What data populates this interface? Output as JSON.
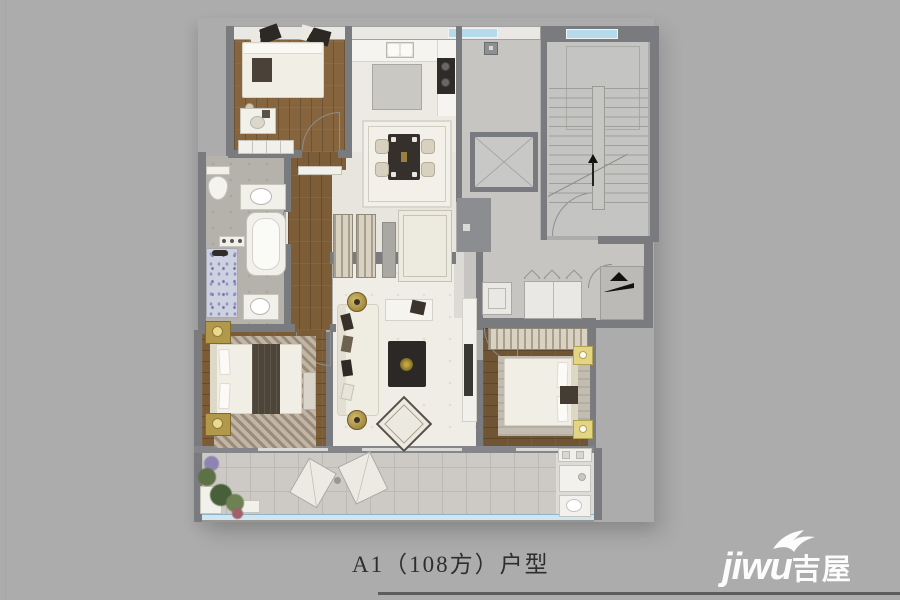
{
  "title": {
    "text": "A1（108方）户型"
  },
  "watermark": {
    "latin": "jiwu",
    "cjk": "吉屋"
  },
  "palette": {
    "background": "#acacac",
    "wall_dark": "#7a7b7f",
    "wall_light": "#e9e8e5",
    "wood": "#85643e",
    "marble": "#efede6",
    "corridor_gray": "#c6c5c2",
    "bathroom_gray": "#b5b2ac",
    "balcony_gray": "#cdcac5",
    "window_blue": "#b5daea",
    "railing_blue": "#cfe6f0",
    "gold_accent": "#b2984a",
    "furniture_dark": "#35302c"
  }
}
